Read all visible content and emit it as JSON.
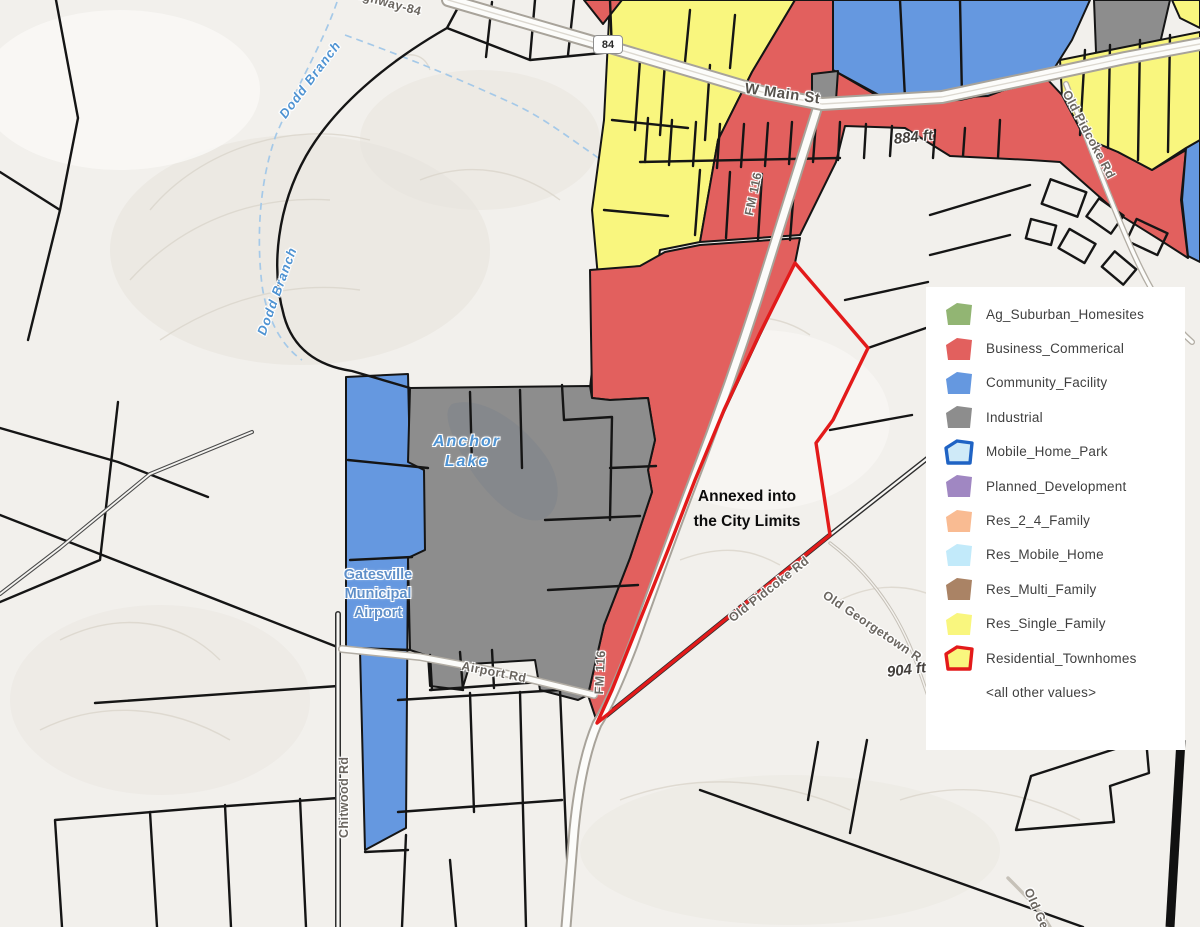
{
  "map": {
    "labels": {
      "highway_top": "Highway-84",
      "shield": "84",
      "w_main_st": "W Main St",
      "elev_884": "884 ft",
      "elev_904": "904 ft",
      "fm116_a": "FM 116",
      "fm116_b": "FM 116",
      "airport_rd": "Airport Rd",
      "chitwood_rd": "Chitwood Rd",
      "old_pidcoke_north": "Old Pidcoke Rd",
      "old_pidcoke_south": "Old Pidcoke Rd",
      "old_georgetown": "Old Georgetown R",
      "old_georgetown_bottom": "Old Geor",
      "dodd_branch_a": "Dodd Branch",
      "dodd_branch_b": "Dodd Branch",
      "anchor_lake": "Anchor\nLake",
      "airport_name": "Gatesville\nMunicipal\nAirport",
      "annexed_note": "Annexed into\nthe City Limits"
    },
    "colors": {
      "business": "#e2605e",
      "community": "#6598e0",
      "industrial": "#8d8d8d",
      "res_single": "#f9f67e",
      "annex_outline": "#e31a1a",
      "water": "#4f93d2"
    }
  },
  "legend": {
    "items": [
      {
        "label": "Ag_Suburban_Homesites",
        "fill": "#92b573",
        "stroke": "none"
      },
      {
        "label": "Business_Commerical",
        "fill": "#e2605e",
        "stroke": "none"
      },
      {
        "label": "Community_Facility",
        "fill": "#6598e0",
        "stroke": "none"
      },
      {
        "label": "Industrial",
        "fill": "#8d8d8d",
        "stroke": "none"
      },
      {
        "label": "Mobile_Home_Park",
        "fill": "#cfeaf8",
        "stroke": "#1f63c4"
      },
      {
        "label": "Planned_Development",
        "fill": "#a087c2",
        "stroke": "none"
      },
      {
        "label": "Res_2_4_Family",
        "fill": "#f9bb92",
        "stroke": "none"
      },
      {
        "label": "Res_Mobile_Home",
        "fill": "#c2eafa",
        "stroke": "none"
      },
      {
        "label": "Res_Multi_Family",
        "fill": "#aa8365",
        "stroke": "none"
      },
      {
        "label": "Res_Single_Family",
        "fill": "#f9f67e",
        "stroke": "none"
      },
      {
        "label": "Residential_Townhomes",
        "fill": "#f9f67e",
        "stroke": "#e31a1a"
      },
      {
        "label": "<all other values>",
        "fill": "none",
        "stroke": "none"
      }
    ]
  }
}
